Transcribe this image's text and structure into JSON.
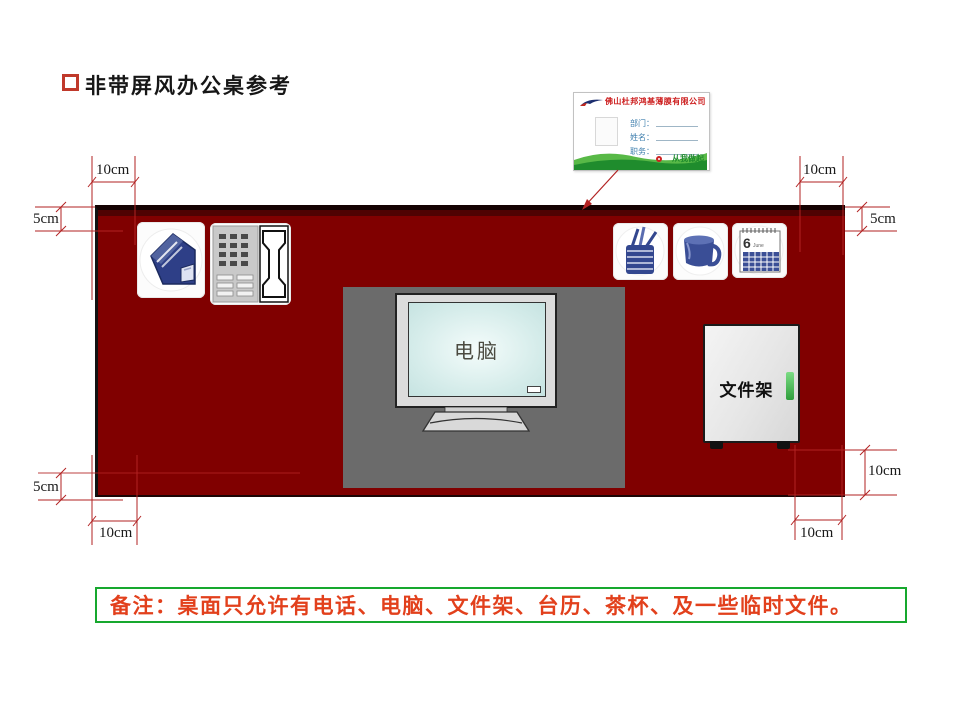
{
  "title": {
    "text": "非带屏风办公桌参考"
  },
  "name_card": {
    "company": "佛山杜邦鸿基薄膜有限公司",
    "fields": [
      "部门：",
      "姓名：",
      "职务："
    ],
    "slogan": "从我做起"
  },
  "desk": {
    "monitor_label": "电脑",
    "file_rack_label": "文件架"
  },
  "calendar": {
    "day": "6",
    "month": "June"
  },
  "dimensions": {
    "top_left_width": "10cm",
    "top_left_height": "5cm",
    "top_right_width": "10cm",
    "top_right_height": "5cm",
    "bottom_left_height": "5cm",
    "bottom_left_width": "10cm",
    "bottom_right_height": "10cm",
    "bottom_right_width": "10cm"
  },
  "note": {
    "text": "备注：桌面只允许有电话、电脑、文件架、台历、茶杯、及一些临时文件。"
  },
  "icons": {
    "file_organizer": "magazine-file-icon",
    "telephone": "telephone-icon",
    "pen_holder": "pen-holder-icon",
    "tea_cup": "tea-cup-icon",
    "desk_calendar": "calendar-icon"
  },
  "colors": {
    "desk": "#800000",
    "desk_edge": "#140202",
    "mat": "#6b6b6b",
    "dimension_line": "#b22222",
    "note_text": "#e2401c",
    "note_border": "#17a82e",
    "icon_blue": "#33478f",
    "handle_green": "#2f9e3c",
    "title_bullet": "#c0392b"
  }
}
